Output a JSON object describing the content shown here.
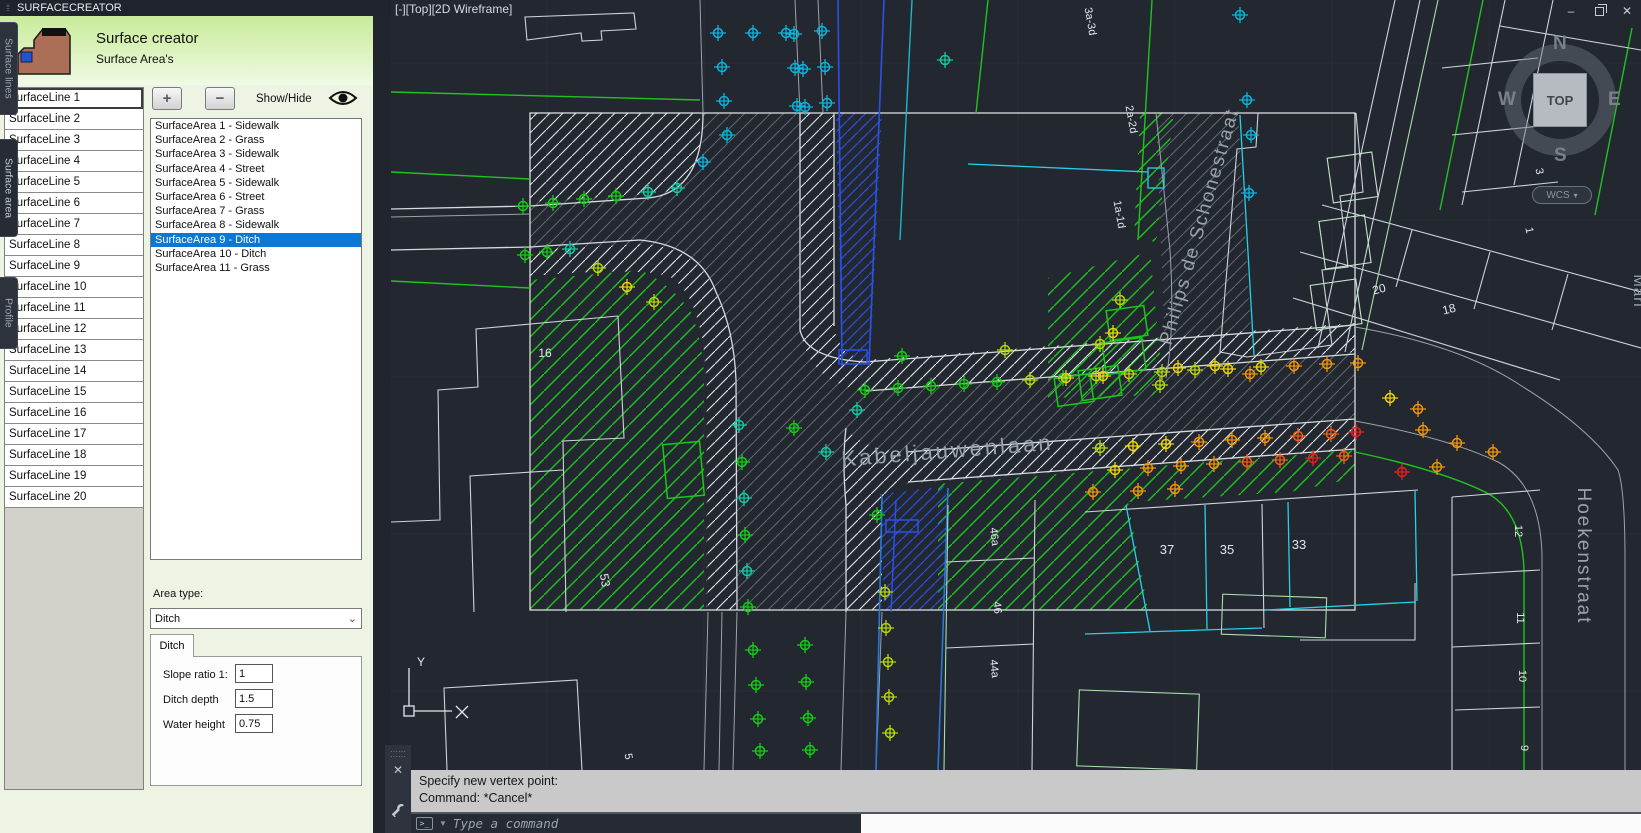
{
  "window": {
    "title": "SURFACECREATOR",
    "controls": {
      "minimize": "–",
      "restore": "",
      "close": "✕"
    }
  },
  "panel": {
    "header": {
      "title": "Surface creator",
      "subtitle": "Surface Area's"
    },
    "toolbar": {
      "add_label": "+",
      "remove_label": "−",
      "show_hide_label": "Show/Hide"
    },
    "surface_lines": [
      "SurfaceLine 1",
      "SurfaceLine 2",
      "SurfaceLine 3",
      "SurfaceLine 4",
      "SurfaceLine 5",
      "SurfaceLine 6",
      "SurfaceLine 7",
      "SurfaceLine 8",
      "SurfaceLine 9",
      "SurfaceLine 10",
      "SurfaceLine 11",
      "SurfaceLine 12",
      "SurfaceLine 13",
      "SurfaceLine 14",
      "SurfaceLine 15",
      "SurfaceLine 16",
      "SurfaceLine 17",
      "SurfaceLine 18",
      "SurfaceLine 19",
      "SurfaceLine 20"
    ],
    "surface_areas": {
      "selected_index": 8,
      "items": [
        "SurfaceArea 1 - Sidewalk",
        "SurfaceArea 2 - Grass",
        "SurfaceArea 3 - Sidewalk",
        "SurfaceArea 4 - Street",
        "SurfaceArea 5 - Sidewalk",
        "SurfaceArea 6 - Street",
        "SurfaceArea 7 - Grass",
        "SurfaceArea 8 - Sidewalk",
        "SurfaceArea 9 - Ditch",
        "SurfaceArea 10 - Ditch",
        "SurfaceArea 11 - Grass"
      ]
    },
    "area_type": {
      "label": "Area type:",
      "value": "Ditch"
    },
    "ditch_tab": {
      "title": "Ditch",
      "fields": [
        {
          "label": "Slope ratio 1:",
          "value": "1"
        },
        {
          "label": "Ditch depth",
          "value": "1.5"
        },
        {
          "label": "Water height",
          "value": "0.75"
        }
      ]
    },
    "side_tabs": [
      {
        "label": "Surface lines",
        "active": false
      },
      {
        "label": "Surface area",
        "active": true
      },
      {
        "label": "Profile",
        "active": false
      }
    ]
  },
  "viewport": {
    "corner_label": "[-][Top][2D Wireframe]",
    "viewcube": {
      "n": "N",
      "w": "W",
      "e": "E",
      "s": "S",
      "face": "TOP",
      "wcs": "WCS"
    },
    "ucs": {
      "x": "X",
      "y": "Y"
    }
  },
  "command": {
    "history": [
      "Specify new vertex point:",
      "Command: *Cancel*"
    ],
    "placeholder": "Type a command"
  },
  "map": {
    "street_labels": [
      {
        "text": "Kabeljauwenlaan",
        "x": 948,
        "y": 458,
        "r": -4.5,
        "s": 22,
        "c": "#99a1ab",
        "ls": 3
      },
      {
        "text": "Philips de Schonestraat",
        "x": 1205,
        "y": 228,
        "r": -74,
        "s": 19,
        "c": "#99a1ab",
        "ls": 2
      },
      {
        "text": "Hoekenstraat",
        "x": 1578,
        "y": 556,
        "r": 90,
        "s": 19,
        "c": "#99a1ab",
        "ls": 2
      },
      {
        "text": "Mari",
        "x": 1634,
        "y": 291,
        "r": 90,
        "s": 15,
        "c": "#99a1ab",
        "ls": 1
      }
    ],
    "parcel_labels": [
      {
        "text": "16",
        "x": 545,
        "y": 357,
        "r": 0,
        "s": 12
      },
      {
        "text": "53",
        "x": 601,
        "y": 581,
        "r": 80,
        "s": 12
      },
      {
        "text": "20",
        "x": 1380,
        "y": 293,
        "r": -14,
        "s": 12
      },
      {
        "text": "18",
        "x": 1450,
        "y": 313,
        "r": -14,
        "s": 12
      },
      {
        "text": "37",
        "x": 1167,
        "y": 554,
        "r": 0,
        "s": 13
      },
      {
        "text": "35",
        "x": 1227,
        "y": 554,
        "r": 0,
        "s": 13
      },
      {
        "text": "33",
        "x": 1299,
        "y": 549,
        "r": 0,
        "s": 13
      },
      {
        "text": "12",
        "x": 1515,
        "y": 531,
        "r": 90,
        "s": 11
      },
      {
        "text": "11",
        "x": 1517,
        "y": 618,
        "r": 90,
        "s": 11
      },
      {
        "text": "10",
        "x": 1519,
        "y": 676,
        "r": 90,
        "s": 11
      },
      {
        "text": "9",
        "x": 1521,
        "y": 748,
        "r": 90,
        "s": 11
      },
      {
        "text": "46a",
        "x": 991,
        "y": 537,
        "r": 84,
        "s": 11
      },
      {
        "text": "46",
        "x": 994,
        "y": 608,
        "r": 84,
        "s": 11
      },
      {
        "text": "44a",
        "x": 991,
        "y": 669,
        "r": 84,
        "s": 11
      },
      {
        "text": "2a-2d",
        "x": 1128,
        "y": 120,
        "r": 80,
        "s": 11
      },
      {
        "text": "1a-1d",
        "x": 1116,
        "y": 215,
        "r": 80,
        "s": 11
      },
      {
        "text": "3a-3d",
        "x": 1087,
        "y": 22,
        "r": 80,
        "s": 11
      },
      {
        "text": "5",
        "x": 625,
        "y": 757,
        "r": 80,
        "s": 11
      },
      {
        "text": "5",
        "x": 1548,
        "y": 106,
        "r": 78,
        "s": 11
      },
      {
        "text": "3",
        "x": 1536,
        "y": 172,
        "r": 78,
        "s": 11
      },
      {
        "text": "1",
        "x": 1526,
        "y": 231,
        "r": 78,
        "s": 11
      }
    ],
    "marker_colors": {
      "g": "#14cc14",
      "t": "#12c9a2",
      "c": "#0ab4dc",
      "yg": "#b6d40a",
      "y": "#e8d20a",
      "o": "#f0940a",
      "ro": "#f25c14",
      "r": "#e61e1e"
    },
    "markers": [
      [
        523,
        206,
        "g"
      ],
      [
        553,
        203,
        "g"
      ],
      [
        584,
        199,
        "g"
      ],
      [
        616,
        196,
        "g"
      ],
      [
        648,
        192,
        "t"
      ],
      [
        677,
        188,
        "t"
      ],
      [
        718,
        33,
        "c"
      ],
      [
        753,
        33,
        "c"
      ],
      [
        786,
        33,
        "c"
      ],
      [
        794,
        34,
        "c"
      ],
      [
        822,
        31,
        "c"
      ],
      [
        722,
        67,
        "c"
      ],
      [
        795,
        68,
        "c"
      ],
      [
        803,
        69,
        "c"
      ],
      [
        825,
        67,
        "c"
      ],
      [
        724,
        101,
        "c"
      ],
      [
        797,
        106,
        "c"
      ],
      [
        805,
        107,
        "c"
      ],
      [
        827,
        103,
        "c"
      ],
      [
        703,
        162,
        "c"
      ],
      [
        727,
        135,
        "c"
      ],
      [
        945,
        60,
        "t"
      ],
      [
        525,
        255,
        "g"
      ],
      [
        547,
        252,
        "g"
      ],
      [
        570,
        249,
        "t"
      ],
      [
        598,
        268,
        "yg"
      ],
      [
        627,
        287,
        "y"
      ],
      [
        654,
        302,
        "yg"
      ],
      [
        1240,
        15,
        "c"
      ],
      [
        1247,
        100,
        "c"
      ],
      [
        1251,
        135,
        "c"
      ],
      [
        1249,
        193,
        "c"
      ],
      [
        739,
        425,
        "t"
      ],
      [
        742,
        462,
        "g"
      ],
      [
        744,
        498,
        "t"
      ],
      [
        745,
        535,
        "g"
      ],
      [
        747,
        571,
        "t"
      ],
      [
        748,
        607,
        "g"
      ],
      [
        753,
        650,
        "g"
      ],
      [
        756,
        685,
        "g"
      ],
      [
        758,
        719,
        "g"
      ],
      [
        760,
        751,
        "g"
      ],
      [
        805,
        645,
        "g"
      ],
      [
        806,
        682,
        "g"
      ],
      [
        808,
        718,
        "g"
      ],
      [
        810,
        750,
        "g"
      ],
      [
        885,
        592,
        "yg"
      ],
      [
        886,
        628,
        "yg"
      ],
      [
        888,
        662,
        "yg"
      ],
      [
        889,
        697,
        "yg"
      ],
      [
        890,
        733,
        "yg"
      ],
      [
        877,
        515,
        "g"
      ],
      [
        857,
        410,
        "t"
      ],
      [
        794,
        428,
        "g"
      ],
      [
        826,
        452,
        "t"
      ],
      [
        865,
        390,
        "g"
      ],
      [
        898,
        388,
        "g"
      ],
      [
        931,
        386,
        "g"
      ],
      [
        964,
        384,
        "g"
      ],
      [
        997,
        382,
        "g"
      ],
      [
        1030,
        380,
        "yg"
      ],
      [
        1063,
        378,
        "g"
      ],
      [
        1096,
        376,
        "yg"
      ],
      [
        1129,
        374,
        "yg"
      ],
      [
        1162,
        372,
        "yg"
      ],
      [
        1195,
        370,
        "yg"
      ],
      [
        1228,
        369,
        "y"
      ],
      [
        1261,
        367,
        "y"
      ],
      [
        1294,
        366,
        "o"
      ],
      [
        1327,
        364,
        "o"
      ],
      [
        1358,
        363,
        "o"
      ],
      [
        902,
        356,
        "g"
      ],
      [
        1005,
        350,
        "yg"
      ],
      [
        1100,
        344,
        "yg"
      ],
      [
        1100,
        448,
        "yg"
      ],
      [
        1133,
        446,
        "y"
      ],
      [
        1166,
        444,
        "y"
      ],
      [
        1199,
        442,
        "o"
      ],
      [
        1232,
        440,
        "o"
      ],
      [
        1265,
        438,
        "o"
      ],
      [
        1298,
        436,
        "ro"
      ],
      [
        1331,
        434,
        "ro"
      ],
      [
        1356,
        432,
        "r"
      ],
      [
        1115,
        470,
        "y"
      ],
      [
        1148,
        468,
        "o"
      ],
      [
        1181,
        466,
        "o"
      ],
      [
        1214,
        464,
        "o"
      ],
      [
        1247,
        462,
        "ro"
      ],
      [
        1280,
        460,
        "ro"
      ],
      [
        1313,
        458,
        "r"
      ],
      [
        1344,
        456,
        "ro"
      ],
      [
        1093,
        492,
        "o"
      ],
      [
        1138,
        491,
        "o"
      ],
      [
        1175,
        489,
        "o"
      ],
      [
        1390,
        398,
        "y"
      ],
      [
        1423,
        430,
        "o"
      ],
      [
        1457,
        443,
        "o"
      ],
      [
        1493,
        452,
        "o"
      ],
      [
        1402,
        472,
        "r"
      ],
      [
        1437,
        467,
        "o"
      ],
      [
        1418,
        409,
        "o"
      ],
      [
        1160,
        385,
        "yg"
      ],
      [
        1178,
        368,
        "y"
      ],
      [
        1215,
        366,
        "y"
      ],
      [
        1250,
        374,
        "o"
      ],
      [
        1066,
        378,
        "y"
      ],
      [
        1103,
        376,
        "y"
      ],
      [
        1113,
        333,
        "y"
      ],
      [
        1120,
        300,
        "yg"
      ]
    ]
  }
}
